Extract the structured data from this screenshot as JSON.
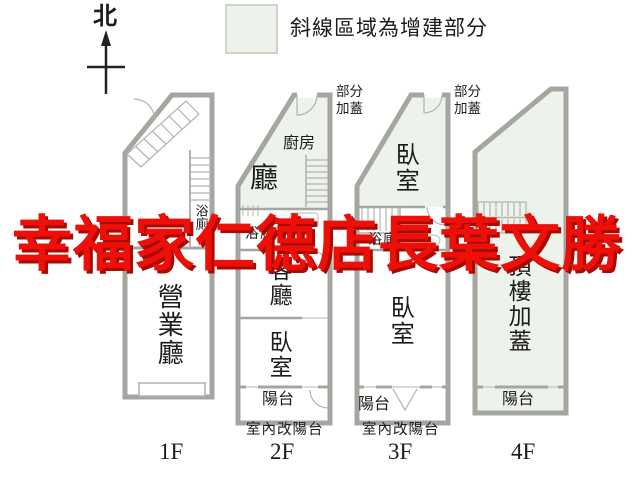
{
  "compass": {
    "label": "北"
  },
  "legend": {
    "text": "斜線區域為增建部分"
  },
  "watermark": {
    "text": "幸福家仁德店長葉文勝"
  },
  "annotations": {
    "partial_cover_left": "部分\n加蓋",
    "partial_cover_right": "部分\n加蓋"
  },
  "floors": [
    {
      "label": "1F",
      "rooms": {
        "hall": "營業廳",
        "bath": "浴廁"
      }
    },
    {
      "label": "2F",
      "note": "室內改陽台",
      "rooms": {
        "kitchen": "廚房",
        "hall": "廳",
        "bath": "浴廁",
        "living": "客廳",
        "bedroom": "臥室",
        "balcony": "陽台"
      }
    },
    {
      "label": "3F",
      "note": "室內改陽台",
      "rooms": {
        "bedroom_top": "臥室",
        "bath": "浴廁",
        "bedroom": "臥室",
        "balcony": "陽台"
      }
    },
    {
      "label": "4F",
      "rooms": {
        "rooftop": "頂樓加蓋",
        "balcony": "陽台"
      }
    }
  ],
  "colors": {
    "watermark_red": "#ee1008",
    "addition_green": "#edf2ea",
    "wall_gray": "#a6a6a0"
  }
}
